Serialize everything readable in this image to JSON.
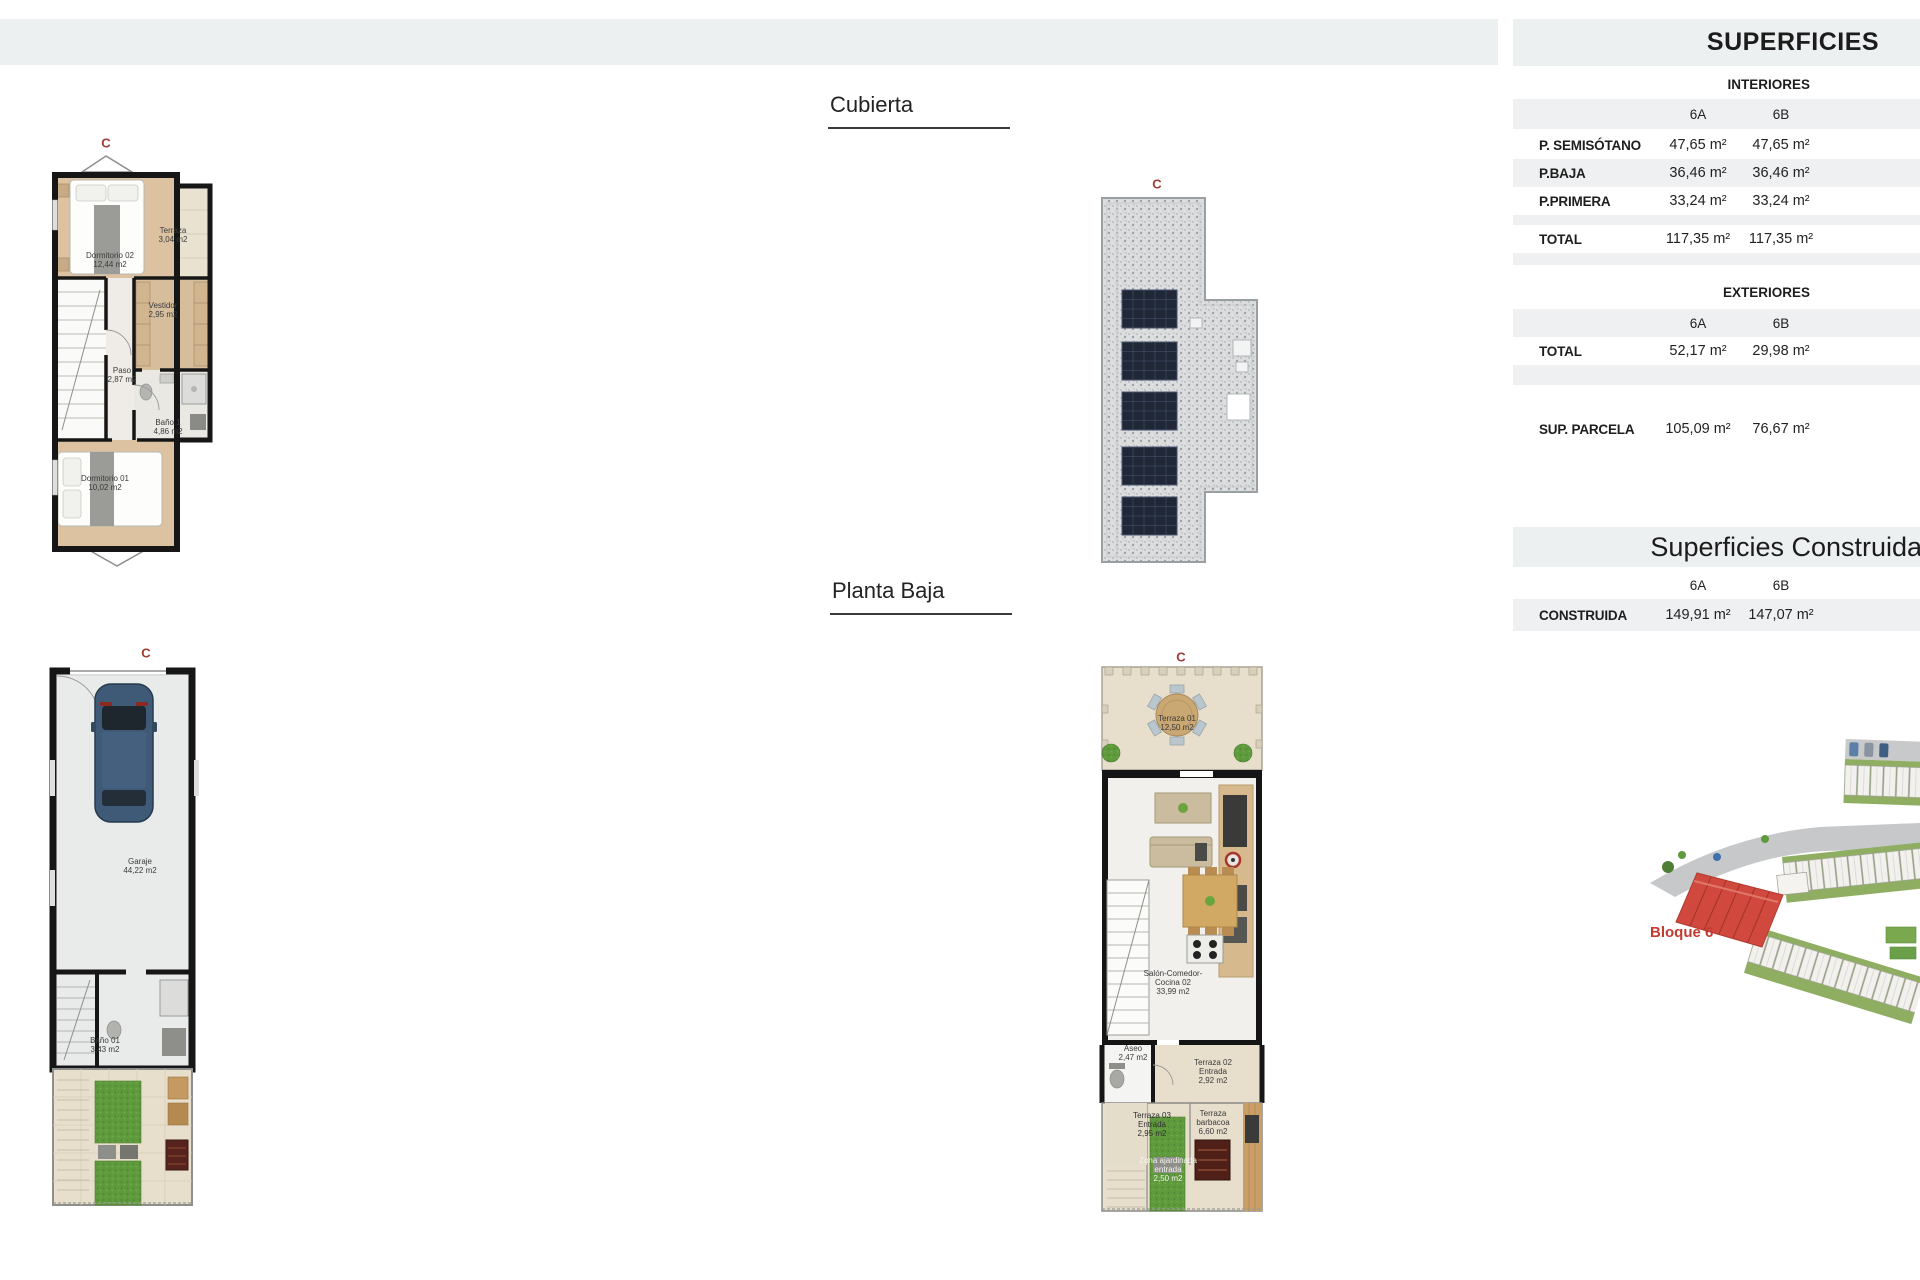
{
  "markers": {
    "c": "C"
  },
  "section_titles": {
    "cubierta": "Cubierta",
    "planta_baja": "Planta Baja"
  },
  "superficies": {
    "title": "SUPERFICIES",
    "interior": {
      "title": "INTERIORES",
      "columns": [
        "6A",
        "6B"
      ],
      "rows": [
        {
          "label": "P. SEMISÓTANO",
          "a": "47,65 m²",
          "b": "47,65 m²"
        },
        {
          "label": "P.BAJA",
          "a": "36,46 m²",
          "b": "36,46 m²"
        },
        {
          "label": "P.PRIMERA",
          "a": "33,24 m²",
          "b": "33,24 m²"
        },
        {
          "label": "TOTAL",
          "a": "117,35 m²",
          "b": "117,35 m²"
        }
      ]
    },
    "exterior": {
      "title": "EXTERIORES",
      "columns": [
        "6A",
        "6B"
      ],
      "rows": [
        {
          "label": "TOTAL",
          "a": "52,17 m²",
          "b": "29,98 m²"
        }
      ]
    },
    "parcela": {
      "label": "SUP. PARCELA",
      "a": "105,09 m²",
      "b": "76,67 m²"
    }
  },
  "construidas": {
    "title": "Superficies Construidas",
    "columns": [
      "6A",
      "6B"
    ],
    "rows": [
      {
        "label": "CONSTRUIDA",
        "a": "149,91 m²",
        "b": "147,07 m²"
      }
    ]
  },
  "plan_primera": {
    "rooms": {
      "terraza": "Terraza\n3,04 m2",
      "dormitorio02": "Dormitorio 02\n12,44 m2",
      "vestidor": "Vestidor\n2,95 m2",
      "paso": "Paso\n2,87 m2",
      "bano1": "Baño 1\n4,86 m2",
      "dormitorio01": "Dormitorio 01\n10,02 m2"
    }
  },
  "plan_garaje": {
    "rooms": {
      "garaje": "Garaje\n44,22 m2",
      "bano01": "Baño 01\n3,43 m2"
    }
  },
  "plan_baja": {
    "rooms": {
      "terraza01": "Terraza 01\n12,50 m2",
      "salon": "Salón-Comedor-\nCocina 02\n33,99 m2",
      "aseo": "Aseo\n2,47 m2",
      "terraza02": "Terraza 02\nEntrada\n2,92 m2",
      "terraza03": "Terraza 03\nEntrada\n2,95 m2",
      "barbacoa": "Terraza\nbarbacoa\n6,60 m2",
      "zona": "Zona ajardinada\nentrada\n2,50 m2"
    }
  },
  "site_plan": {
    "block_label": "Bloque 6"
  },
  "colors": {
    "band_gray": "#edf0f1",
    "row_gray": "#eef0f1",
    "accent_red": "#c23b30",
    "wall_black": "#161616",
    "wood_floor": "#dcc2a0",
    "terrace_beige": "#e7decb",
    "grass_green": "#5f9a3d",
    "block_red": "#d0483e"
  }
}
